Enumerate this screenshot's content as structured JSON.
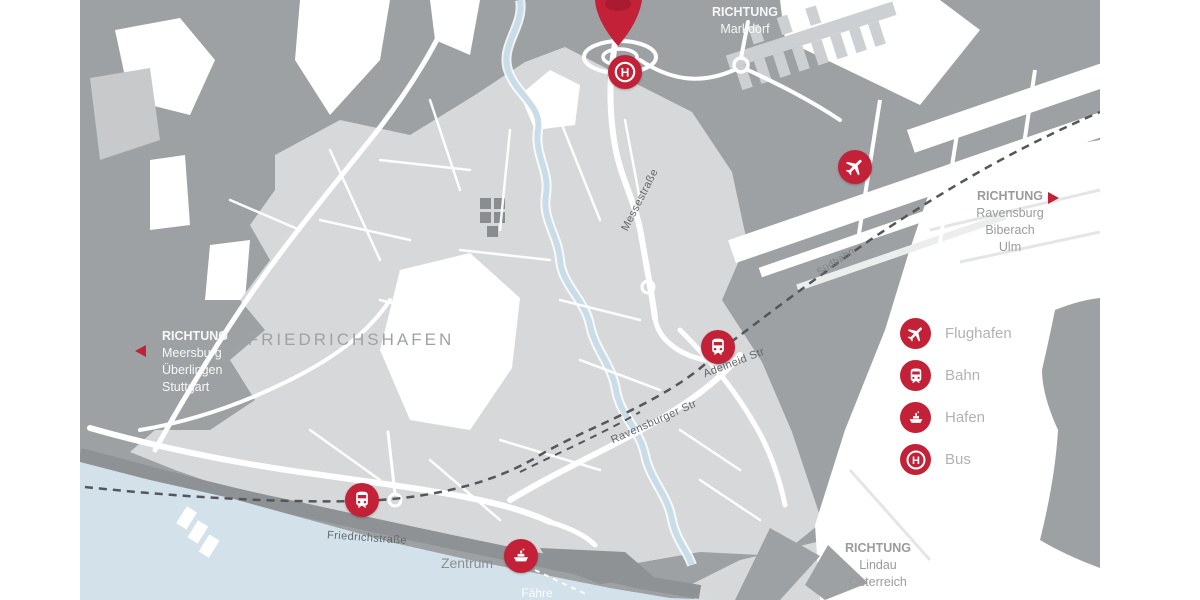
{
  "city": {
    "label": "FRIEDRICHSHAFEN"
  },
  "streets": {
    "messestrasse": "Messestraße",
    "adelheid": "Adelheid Str",
    "suedbahn": "Südbahn",
    "ravensburger": "Ravensburger Str",
    "friedrichstrasse": "Friedrichstraße"
  },
  "places": {
    "zentrum": "Zentrum",
    "faehre": "Fähre"
  },
  "directions": {
    "markdorf": {
      "l1": "RICHTUNG",
      "l2": "Markdorf"
    },
    "ravensburg": {
      "l1": "RICHTUNG",
      "l2": "Ravensburg",
      "l3": "Biberach",
      "l4": "Ulm"
    },
    "meersburg": {
      "l1": "RICHTUNG",
      "l2": "Meersburg",
      "l3": "Überlingen",
      "l4": "Stuttgart"
    },
    "lindau": {
      "l1": "RICHTUNG",
      "l2": "Lindau",
      "l3": "Österreich"
    }
  },
  "legend": {
    "items": [
      {
        "icon": "plane-icon",
        "label": "Flughafen"
      },
      {
        "icon": "train-icon",
        "label": "Bahn"
      },
      {
        "icon": "ship-icon",
        "label": "Hafen"
      },
      {
        "icon": "bus-icon",
        "label": "Bus"
      }
    ]
  },
  "markers": [
    {
      "type": "bus-stop",
      "icon": "bus-icon"
    },
    {
      "type": "airport",
      "icon": "plane-icon"
    },
    {
      "type": "train-station-airport",
      "icon": "train-icon"
    },
    {
      "type": "train-station-city",
      "icon": "train-icon"
    },
    {
      "type": "harbor",
      "icon": "ship-icon"
    }
  ],
  "icons": {
    "bus_letter": "H"
  },
  "colors": {
    "accent_red": "#c32138",
    "land_dark": "#9da1a4",
    "land_light": "#d7d8d9",
    "water": "#d3e2ea",
    "text_gray": "#9b9b9b",
    "text_street": "#64676a"
  }
}
